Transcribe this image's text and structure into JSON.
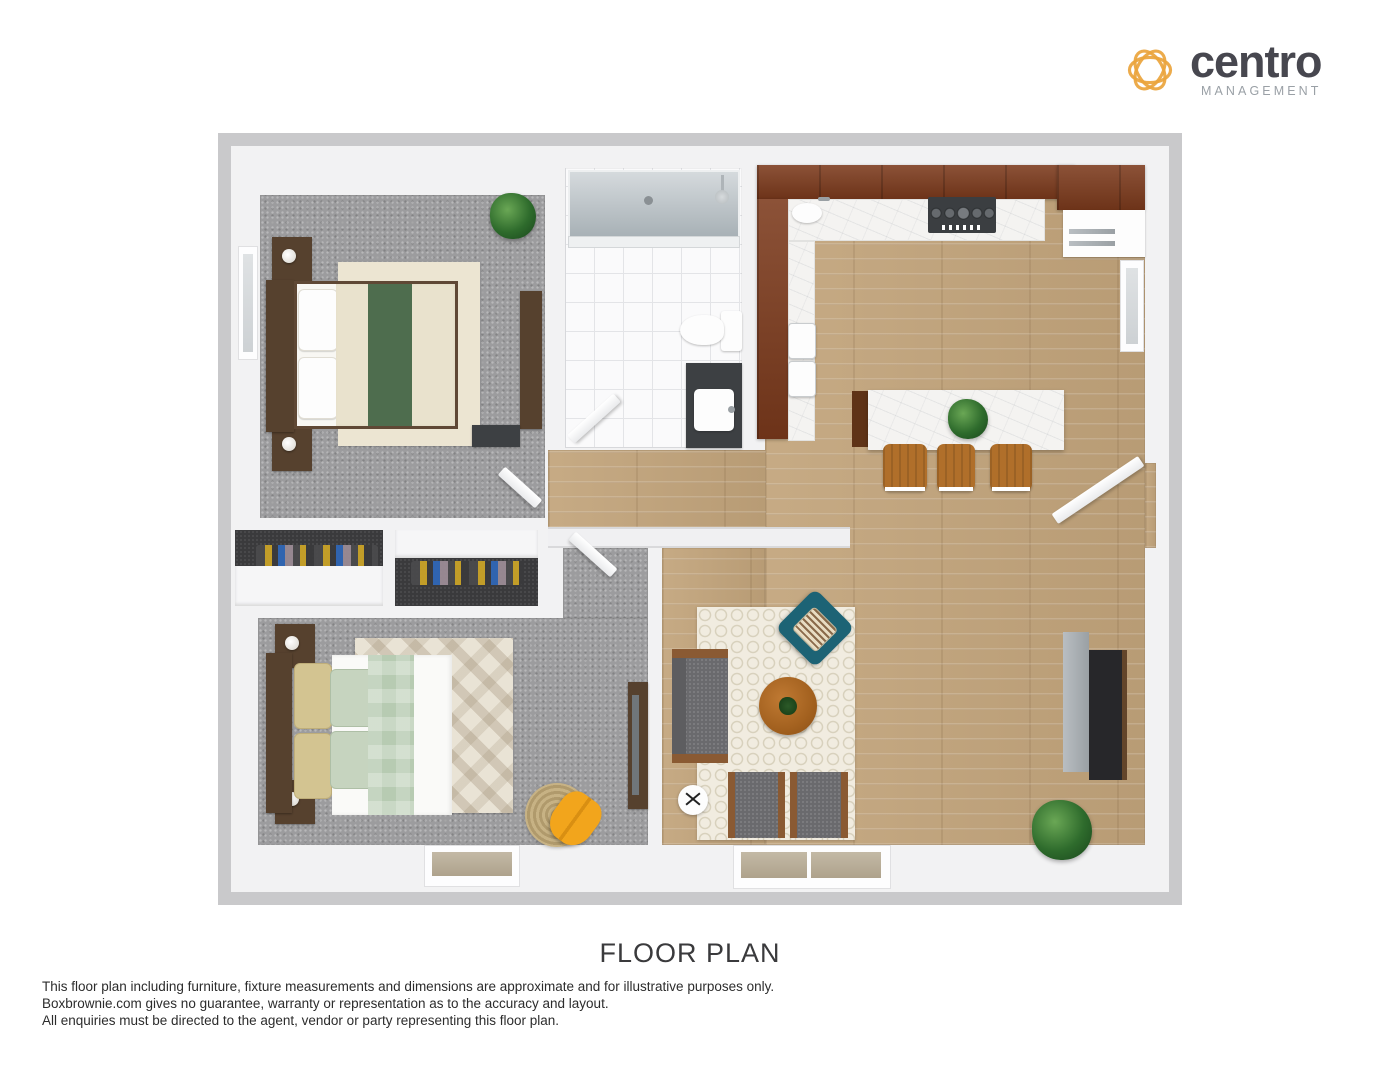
{
  "logo": {
    "brand": "centro",
    "tagline": "MANAGEMENT"
  },
  "title": "FLOOR PLAN",
  "disclaimer": {
    "line1": "This floor plan including furniture, fixture measurements and dimensions are approximate and for illustrative purposes only.",
    "line2": "Boxbrownie.com gives no guarantee, warranty or representation as to the accuracy and layout.",
    "line3": "All enquiries must be directed to the agent, vendor or party representing this floor plan."
  },
  "palette": {
    "logo_icon": "#eaa43c",
    "logo_brand": "#47474f",
    "logo_tagline": "#9aa0a6",
    "wall_outline": "#c9c9cb",
    "wall_fill": "#f2f2f3",
    "carpet": "#9c9c9e",
    "wood_floor": "#c2a47b",
    "tile": "#fafafb",
    "cabinet_cherry": "#7c3a1c",
    "marble": "#f4f3f1",
    "bed1_runner_green": "#4e6d4e",
    "bed2_runner_sage": "#b7cbb2",
    "accent_teal": "#1d6375",
    "accent_yellow": "#f2a51c",
    "sofa_gray": "#6a6a6d",
    "stool_wood": "#b06f2a",
    "plant_green": "#2e6b2c"
  }
}
